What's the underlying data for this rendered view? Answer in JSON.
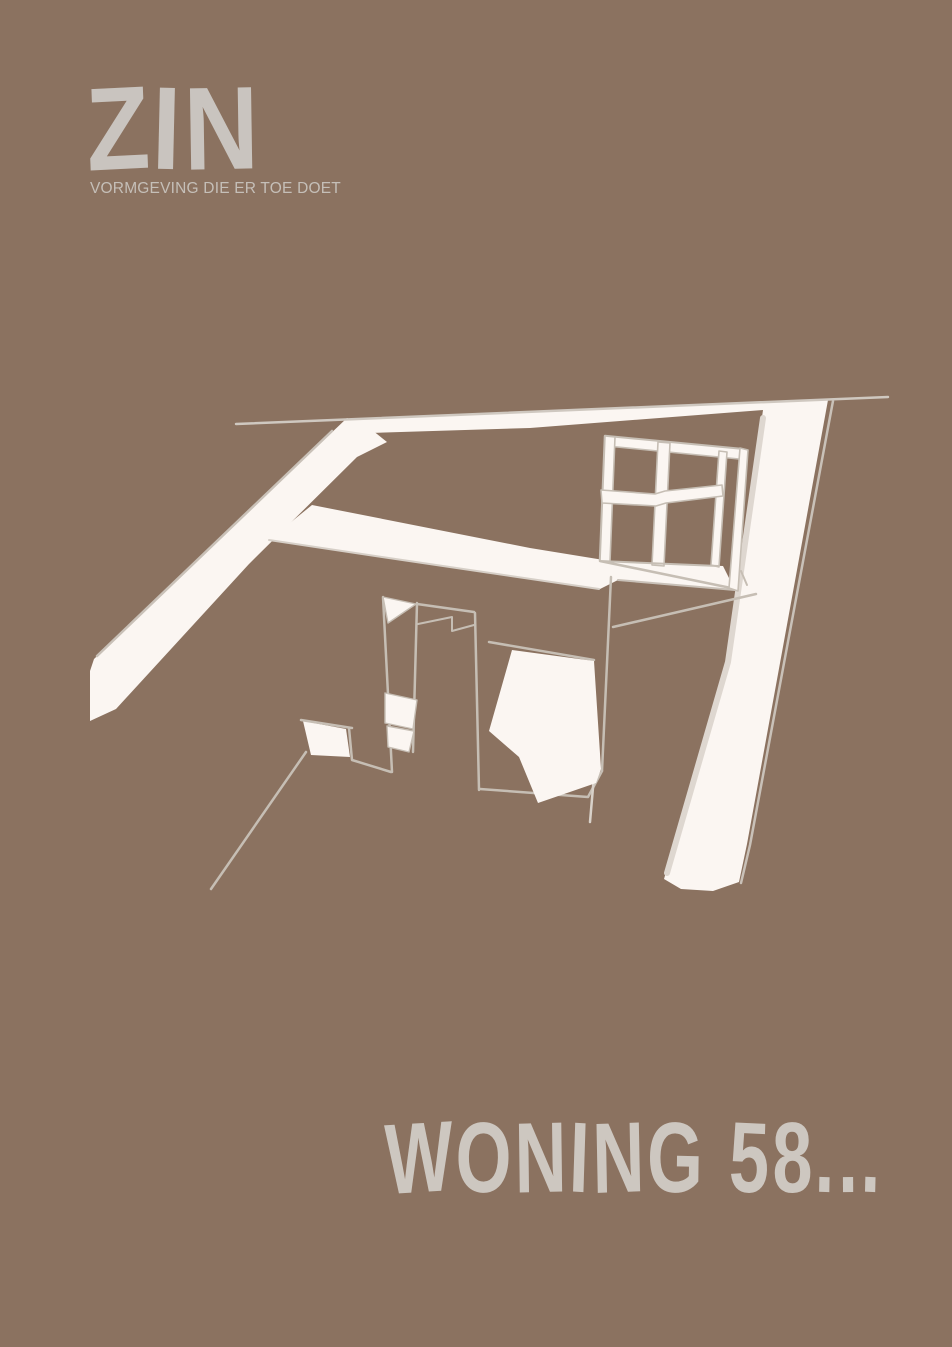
{
  "page": {
    "background_color": "#8b7260"
  },
  "logo": {
    "text": "ZIN",
    "tagline": "VORMGEVING DIE ER TOE DOET",
    "color": "#c9c4bf",
    "tagline_color": "#c5bfb8"
  },
  "title": {
    "text": "WONING 58...",
    "color": "#cdc7c0"
  },
  "illustration": {
    "name": "interior-room-sketch",
    "ink_color": "#fbf6f2",
    "line_color": "#c6beb4"
  }
}
